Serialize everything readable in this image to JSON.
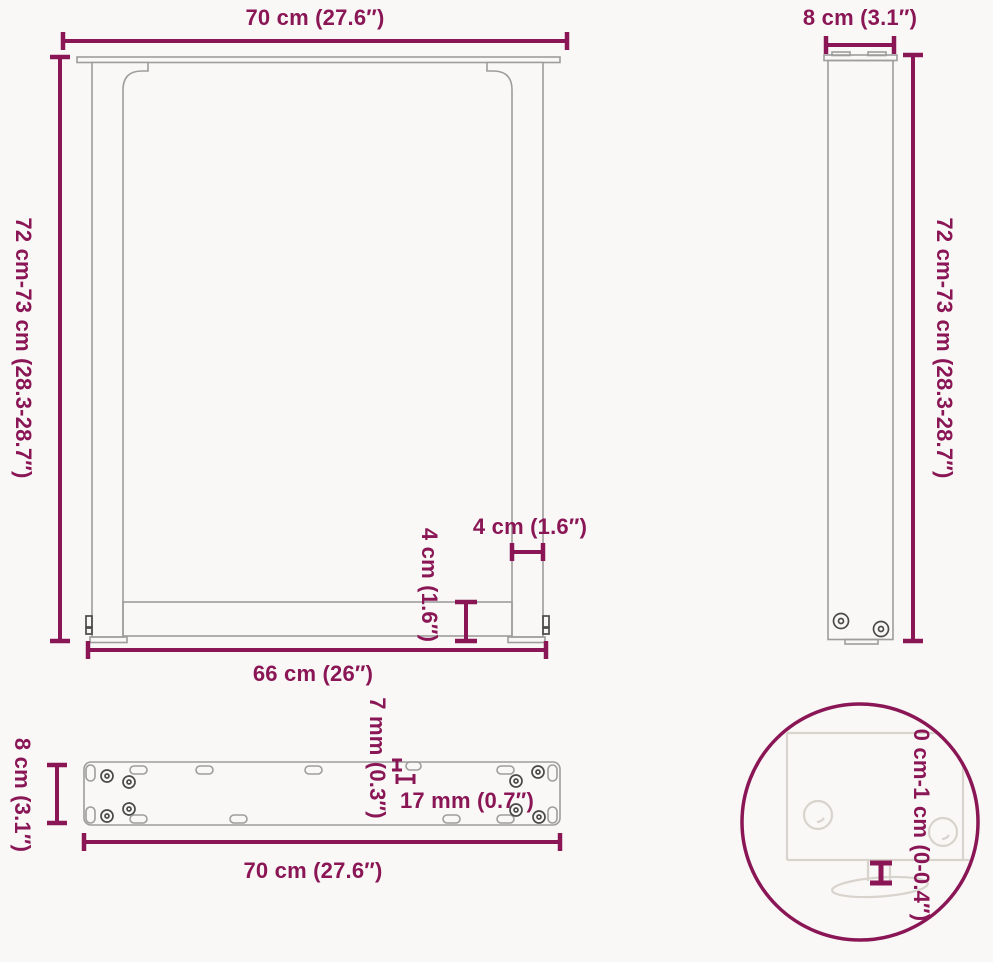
{
  "colors": {
    "dimension": "#8A1656",
    "drawing_line": "#9d9d9d",
    "drawing_dark": "#4a4a4a",
    "detail_line": "#d8d3cc",
    "background": "#f9f8f6"
  },
  "views": {
    "front": {
      "top_width_label": "70 cm (27.6″)",
      "height_label": "72 cm-73 cm (28.3-28.7″)",
      "leg_thickness_label": "4 cm (1.6″)",
      "crossbar_thickness_label": "4 cm (1.6″)",
      "bottom_width_label": "66 cm (26″)"
    },
    "side": {
      "width_label": "8 cm (3.1″)",
      "height_label": "72 cm-73 cm (28.3-28.7″)"
    },
    "top": {
      "depth_label": "8 cm (3.1″)",
      "hole_diameter_label": "7 mm (0.3″)",
      "slot_length_label": "17 mm (0.7″)",
      "width_label": "70 cm (27.6″)"
    },
    "detail": {
      "adjustable_height_label": "0 cm-1 cm (0-0.4″)"
    }
  }
}
